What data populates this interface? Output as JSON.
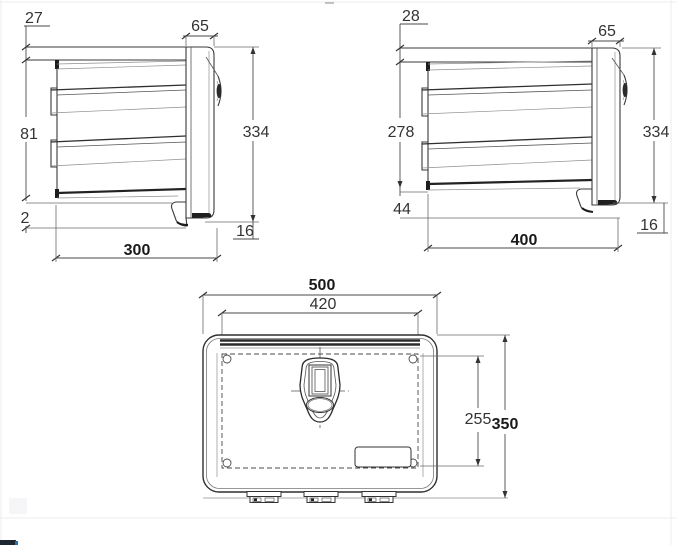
{
  "drawing": {
    "title": "underbody toolbox dimensioned drawing, three views",
    "colors": {
      "line": "#3a3a3a",
      "text": "#333333",
      "background": "#ffffff"
    },
    "views": {
      "side300": {
        "top_offset": "27",
        "lid_depth": "65",
        "bracket_height": "81",
        "height": "334",
        "bottom_offset": "2",
        "foot_height": "16",
        "depth": "300"
      },
      "side400": {
        "top_offset": "28",
        "lid_depth": "65",
        "bracket_height": "278",
        "height": "334",
        "bottom_offset": "44",
        "foot_height": "16",
        "depth": "400"
      },
      "front500": {
        "width": "500",
        "door_width": "420",
        "door_height": "255",
        "height": "350"
      }
    }
  }
}
